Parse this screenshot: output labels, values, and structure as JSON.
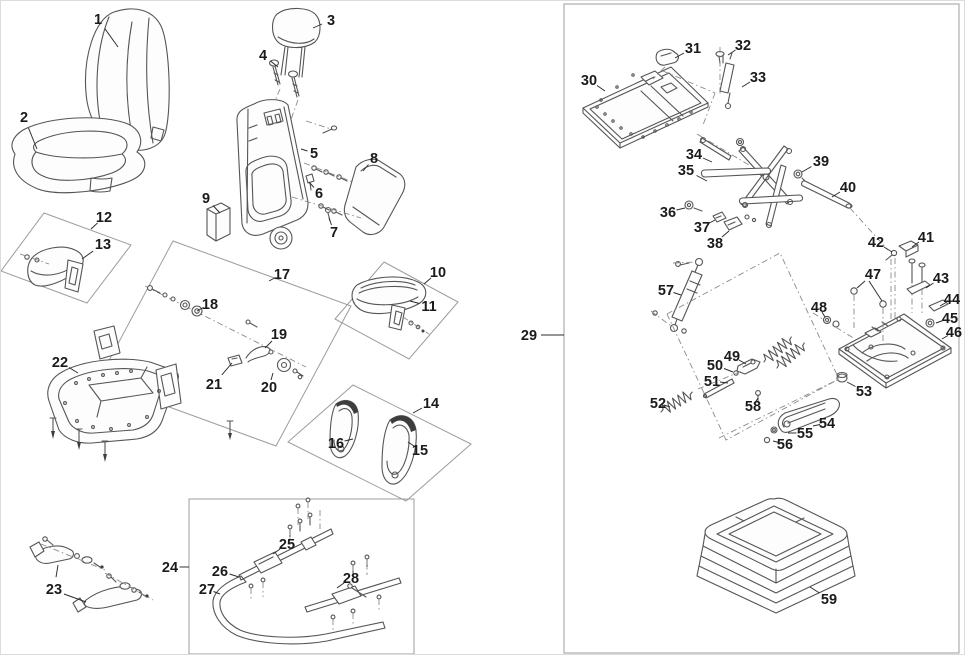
{
  "diagram": {
    "canvas": {
      "width": 965,
      "height": 655
    },
    "colors": {
      "line": "#555555",
      "label": "#1b1b1b",
      "group_box": "#9c9c9c",
      "dash_line": "#8a8a8a",
      "background": "#ffffff"
    },
    "callouts": [
      {
        "n": "1",
        "x": 97,
        "y": 18,
        "lx": 117,
        "ly": 46
      },
      {
        "n": "2",
        "x": 23,
        "y": 116,
        "lx": 36,
        "ly": 148
      },
      {
        "n": "3",
        "x": 330,
        "y": 19,
        "lx": 312,
        "ly": 27
      },
      {
        "n": "4",
        "x": 262,
        "y": 54,
        "lx": 277,
        "ly": 66
      },
      {
        "n": "5",
        "x": 313,
        "y": 152,
        "lx": 300,
        "ly": 148
      },
      {
        "n": "6",
        "x": 318,
        "y": 192,
        "lx": 308,
        "ly": 181
      },
      {
        "n": "7",
        "x": 333,
        "y": 231,
        "lx": 328,
        "ly": 217
      },
      {
        "n": "8",
        "x": 373,
        "y": 157,
        "lx": 362,
        "ly": 170
      },
      {
        "n": "9",
        "x": 205,
        "y": 197,
        "lx": 219,
        "ly": 212
      },
      {
        "n": "10",
        "x": 437,
        "y": 271,
        "lx": 423,
        "ly": 283
      },
      {
        "n": "11",
        "x": 428,
        "y": 305,
        "lx": 409,
        "ly": 300
      },
      {
        "n": "12",
        "x": 103,
        "y": 216,
        "lx": 90,
        "ly": 228
      },
      {
        "n": "13",
        "x": 102,
        "y": 243,
        "lx": 81,
        "ly": 258
      },
      {
        "n": "14",
        "x": 430,
        "y": 402,
        "lx": 412,
        "ly": 412
      },
      {
        "n": "15",
        "x": 419,
        "y": 449,
        "lx": 407,
        "ly": 441
      },
      {
        "n": "16",
        "x": 335,
        "y": 442,
        "lx": 352,
        "ly": 438
      },
      {
        "n": "17",
        "x": 281,
        "y": 273,
        "lx": 268,
        "ly": 280
      },
      {
        "n": "18",
        "x": 209,
        "y": 303,
        "lx": 196,
        "ly": 310
      },
      {
        "n": "19",
        "x": 278,
        "y": 333,
        "lx": 264,
        "ly": 347
      },
      {
        "n": "20",
        "x": 268,
        "y": 386,
        "lx": 272,
        "ly": 372
      },
      {
        "n": "21",
        "x": 213,
        "y": 383,
        "lx": 231,
        "ly": 362
      },
      {
        "n": "22",
        "x": 59,
        "y": 361,
        "lx": 77,
        "ly": 372
      },
      {
        "n": "23",
        "x": 53,
        "y": 588,
        "lx": 57,
        "ly": 564
      },
      {
        "n": "24",
        "x": 169,
        "y": 566,
        "lx": 188,
        "ly": 566
      },
      {
        "n": "25",
        "x": 286,
        "y": 543,
        "lx": 272,
        "ly": 553
      },
      {
        "n": "26",
        "x": 219,
        "y": 570,
        "lx": 238,
        "ly": 576
      },
      {
        "n": "27",
        "x": 206,
        "y": 588,
        "lx": 219,
        "ly": 593
      },
      {
        "n": "28",
        "x": 350,
        "y": 577,
        "lx": 336,
        "ly": 587
      },
      {
        "n": "29",
        "x": 528,
        "y": 334,
        "lx": 563,
        "ly": 334
      },
      {
        "n": "30",
        "x": 588,
        "y": 79,
        "lx": 604,
        "ly": 90
      },
      {
        "n": "31",
        "x": 692,
        "y": 47,
        "lx": 674,
        "ly": 57
      },
      {
        "n": "32",
        "x": 742,
        "y": 44,
        "lx": 727,
        "ly": 54
      },
      {
        "n": "33",
        "x": 757,
        "y": 76,
        "lx": 741,
        "ly": 86
      },
      {
        "n": "34",
        "x": 693,
        "y": 153,
        "lx": 711,
        "ly": 161
      },
      {
        "n": "35",
        "x": 685,
        "y": 169,
        "lx": 706,
        "ly": 180
      },
      {
        "n": "36",
        "x": 667,
        "y": 211,
        "lx": 684,
        "ly": 207
      },
      {
        "n": "37",
        "x": 701,
        "y": 226,
        "lx": 714,
        "ly": 219
      },
      {
        "n": "38",
        "x": 714,
        "y": 242,
        "lx": 728,
        "ly": 230
      },
      {
        "n": "39",
        "x": 820,
        "y": 160,
        "lx": 801,
        "ly": 171
      },
      {
        "n": "40",
        "x": 847,
        "y": 186,
        "lx": 831,
        "ly": 196
      },
      {
        "n": "41",
        "x": 925,
        "y": 236,
        "lx": 911,
        "ly": 246
      },
      {
        "n": "42",
        "x": 875,
        "y": 241,
        "lx": 891,
        "ly": 251
      },
      {
        "n": "43",
        "x": 940,
        "y": 277,
        "lx": 925,
        "ly": 287
      },
      {
        "n": "44",
        "x": 951,
        "y": 298,
        "lx": 939,
        "ly": 305
      },
      {
        "n": "45",
        "x": 949,
        "y": 317,
        "lx": 935,
        "ly": 322
      },
      {
        "n": "46",
        "x": 953,
        "y": 331,
        "lx": 941,
        "ly": 338
      },
      {
        "n": "47",
        "x": 872,
        "y": 273,
        "lx": 856,
        "ly": 287
      },
      {
        "n": "48",
        "x": 818,
        "y": 306,
        "lx": 824,
        "ly": 316
      },
      {
        "n": "49",
        "x": 731,
        "y": 355,
        "lx": 745,
        "ly": 363
      },
      {
        "n": "50",
        "x": 714,
        "y": 364,
        "lx": 732,
        "ly": 371
      },
      {
        "n": "51",
        "x": 711,
        "y": 380,
        "lx": 727,
        "ly": 382
      },
      {
        "n": "52",
        "x": 657,
        "y": 402,
        "lx": 669,
        "ly": 406
      },
      {
        "n": "53",
        "x": 863,
        "y": 390,
        "lx": 846,
        "ly": 381
      },
      {
        "n": "54",
        "x": 826,
        "y": 422,
        "lx": 812,
        "ly": 425
      },
      {
        "n": "55",
        "x": 804,
        "y": 432,
        "lx": 787,
        "ly": 432
      },
      {
        "n": "56",
        "x": 784,
        "y": 443,
        "lx": 772,
        "ly": 440
      },
      {
        "n": "57",
        "x": 665,
        "y": 289,
        "lx": 680,
        "ly": 294
      },
      {
        "n": "58",
        "x": 752,
        "y": 405,
        "lx": 757,
        "ly": 397
      },
      {
        "n": "59",
        "x": 828,
        "y": 598,
        "lx": 809,
        "ly": 586
      }
    ],
    "extra_leaders": [
      {
        "x1": 63,
        "y1": 593,
        "x2": 85,
        "y2": 601
      },
      {
        "x1": 868,
        "y1": 280,
        "x2": 881,
        "y2": 300
      }
    ]
  }
}
